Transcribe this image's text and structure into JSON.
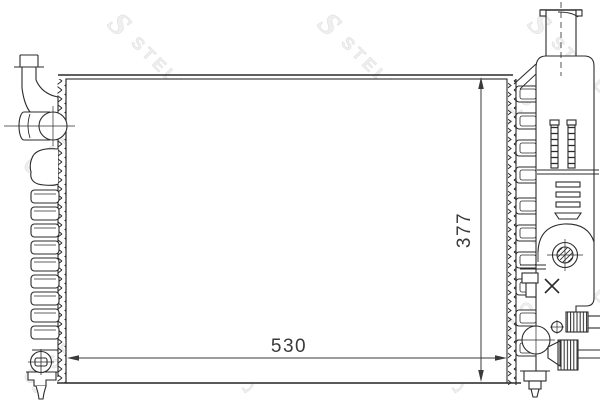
{
  "watermark": {
    "brand": "STELLOX",
    "logo_letter": "S",
    "color": "#e9e9e9"
  },
  "dimensions": {
    "width_label": "530",
    "height_label": "377"
  },
  "colors": {
    "line": "#2b2b2b",
    "dimension_text": "#3a3a3a",
    "background": "#ffffff"
  }
}
